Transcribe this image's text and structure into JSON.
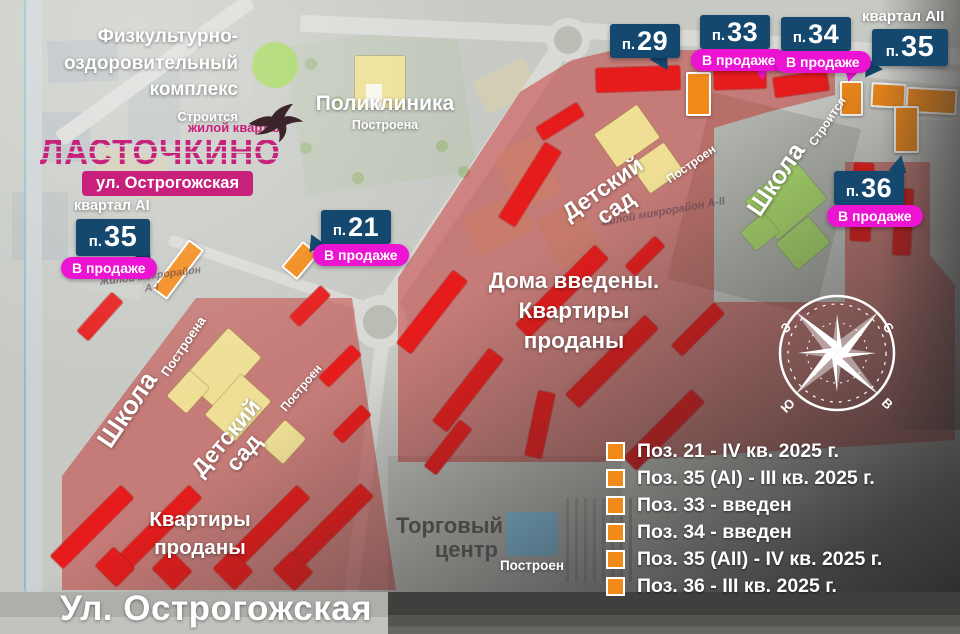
{
  "colors": {
    "badge_navy": "#15486f",
    "sale_magenta": "#ed13d2",
    "brand_magenta": "#c7217b",
    "sold_red": "#e61c1c",
    "onsale_orange": "#f28a1a",
    "built_yellow": "#eedf95",
    "construction_green": "#a9d96c",
    "mall_blue": "#85c6e8"
  },
  "brand": {
    "tagline": "жилой квартал",
    "name": "ЛАСТОЧКИНО",
    "street_band": "ул. Острогожская"
  },
  "labels": {
    "fok": {
      "lines": [
        "Физкультурно-",
        "оздоровительный",
        "комплекс"
      ],
      "status": "Строится"
    },
    "polyclinic": {
      "title": "Поликлиника",
      "status": "Построена"
    },
    "school_right": {
      "title": "Школа",
      "status": "Строится"
    },
    "kindergarten_right": {
      "title": "Детский сад",
      "status": "Построен"
    },
    "school_left": {
      "title": "Школа",
      "status": "Построена"
    },
    "kindergarten_left": {
      "title": "Детский сад",
      "status": "Построен"
    },
    "mall": {
      "lines": [
        "Торговый",
        "центр"
      ],
      "status": "Построен"
    },
    "sold_center": [
      "Дома введены.",
      "Квартиры",
      "проданы"
    ],
    "sold_left": [
      "Квартиры",
      "проданы"
    ],
    "street_bottom": "Ул. Острогожская",
    "quarter_ai": "квартал AI",
    "quarter_aii": "квартал AII",
    "microdistrict_left": [
      "Жилой микрорайон",
      "А-I"
    ],
    "microdistrict_right": "жилой микрорайон А-II"
  },
  "badges": {
    "p35ai": {
      "prefix": "п.",
      "num": "35",
      "sale": "В продаже"
    },
    "p21": {
      "prefix": "п.",
      "num": "21",
      "sale": "В продаже"
    },
    "p29": {
      "prefix": "п.",
      "num": "29"
    },
    "p33": {
      "prefix": "п.",
      "num": "33",
      "sale": "В продаже"
    },
    "p34": {
      "prefix": "п.",
      "num": "34",
      "sale": "В продаже"
    },
    "p35aii": {
      "prefix": "п.",
      "num": "35"
    },
    "p36": {
      "prefix": "п.",
      "num": "36",
      "sale": "В продаже"
    }
  },
  "legend": {
    "items": [
      "Поз. 21 - IV кв. 2025 г.",
      "Поз. 35 (AI) - III кв. 2025 г.",
      "Поз. 33 - введен",
      "Поз. 34 - введен",
      "Поз. 35 (AII) - IV кв. 2025 г.",
      "Поз. 36 - III кв. 2025 г."
    ]
  },
  "compass": {
    "west": "З",
    "north": "С",
    "south": "Ю",
    "east": "В"
  }
}
